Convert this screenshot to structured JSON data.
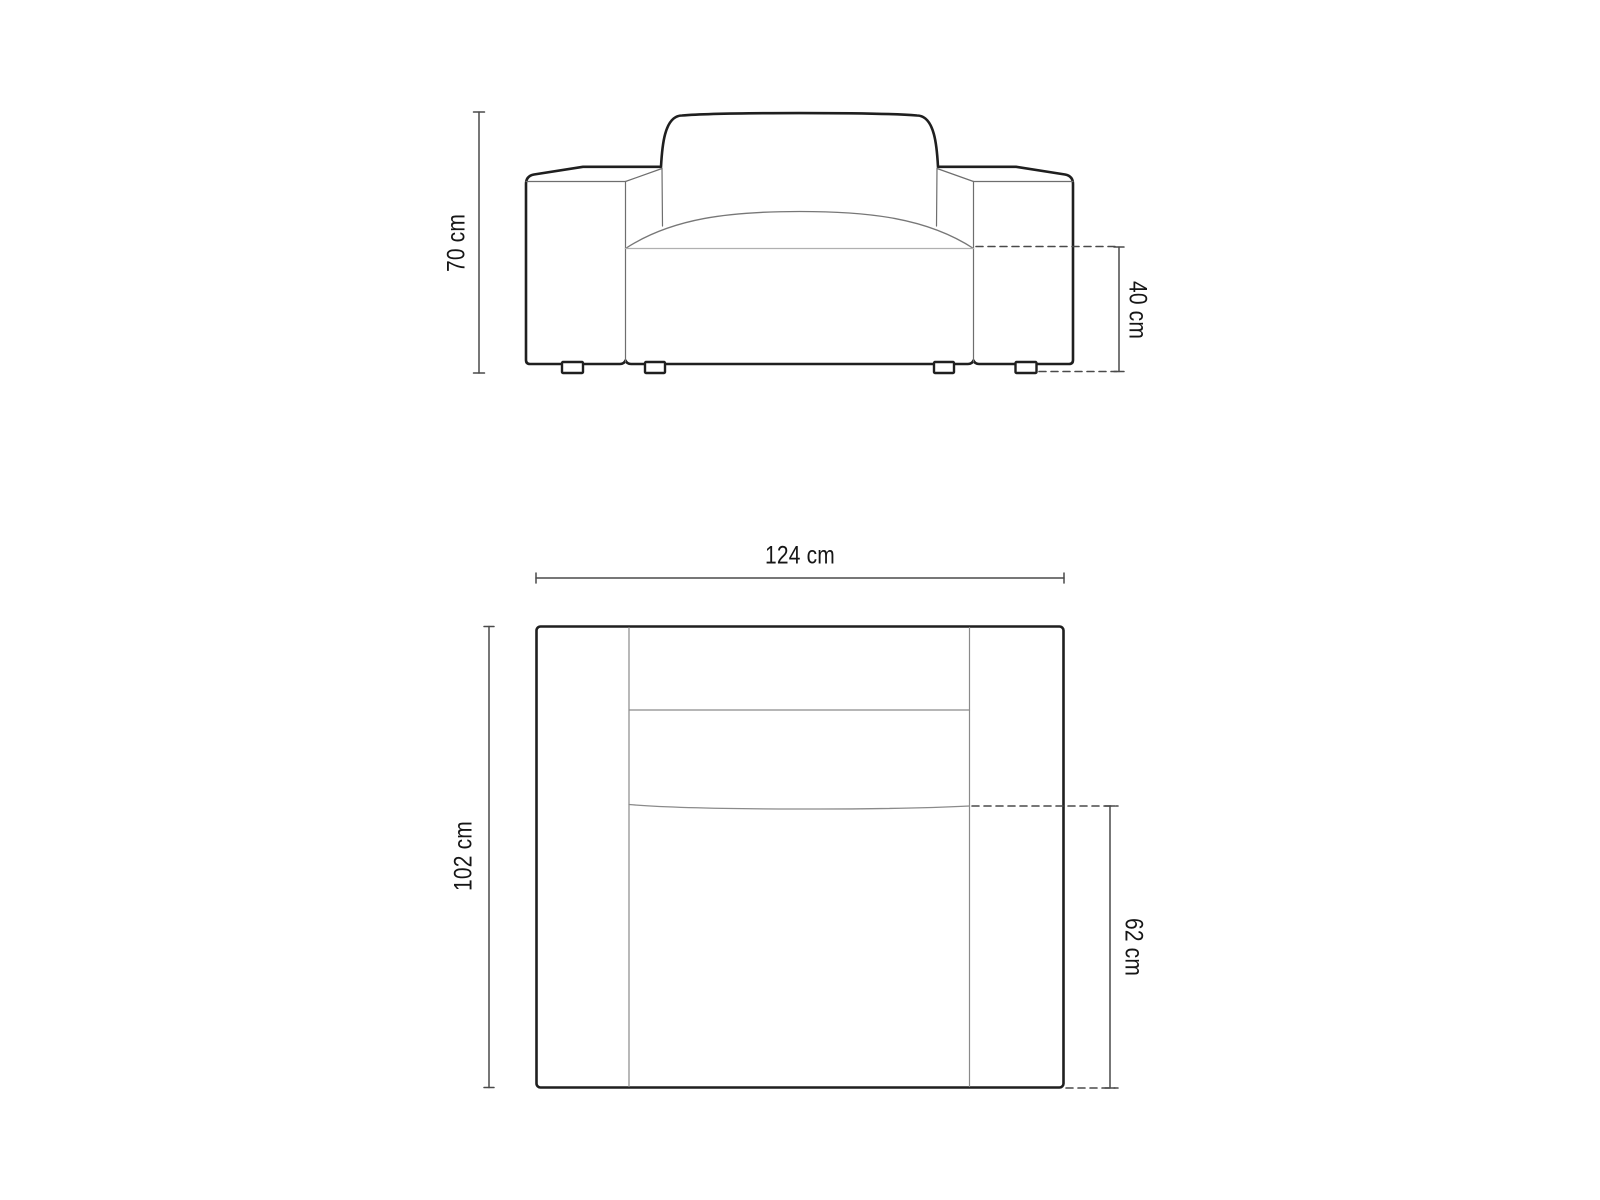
{
  "diagram": {
    "type": "furniture-dimension-drawing",
    "subject": "armchair technical drawing, front elevation and top plan",
    "views": {
      "front": {
        "name": "front-view",
        "dimensions": {
          "height": {
            "label": "70 cm",
            "value": 70,
            "unit": "cm"
          },
          "seat_height": {
            "label": "40 cm",
            "value": 40,
            "unit": "cm"
          }
        }
      },
      "top": {
        "name": "top-view",
        "dimensions": {
          "width": {
            "label": "124 cm",
            "value": 124,
            "unit": "cm"
          },
          "depth": {
            "label": "102 cm",
            "value": 102,
            "unit": "cm"
          },
          "seat_depth": {
            "label": "62 cm",
            "value": 62,
            "unit": "cm"
          }
        }
      }
    },
    "colors": {
      "background": "#ffffff",
      "outline": "#1f1f1f",
      "thin_line": "#6e6e6e",
      "light_line": "#b0b0b0",
      "dashed_line": "#4a4a4a",
      "dimension_line": "#4a4a4a",
      "text": "#161616"
    }
  }
}
